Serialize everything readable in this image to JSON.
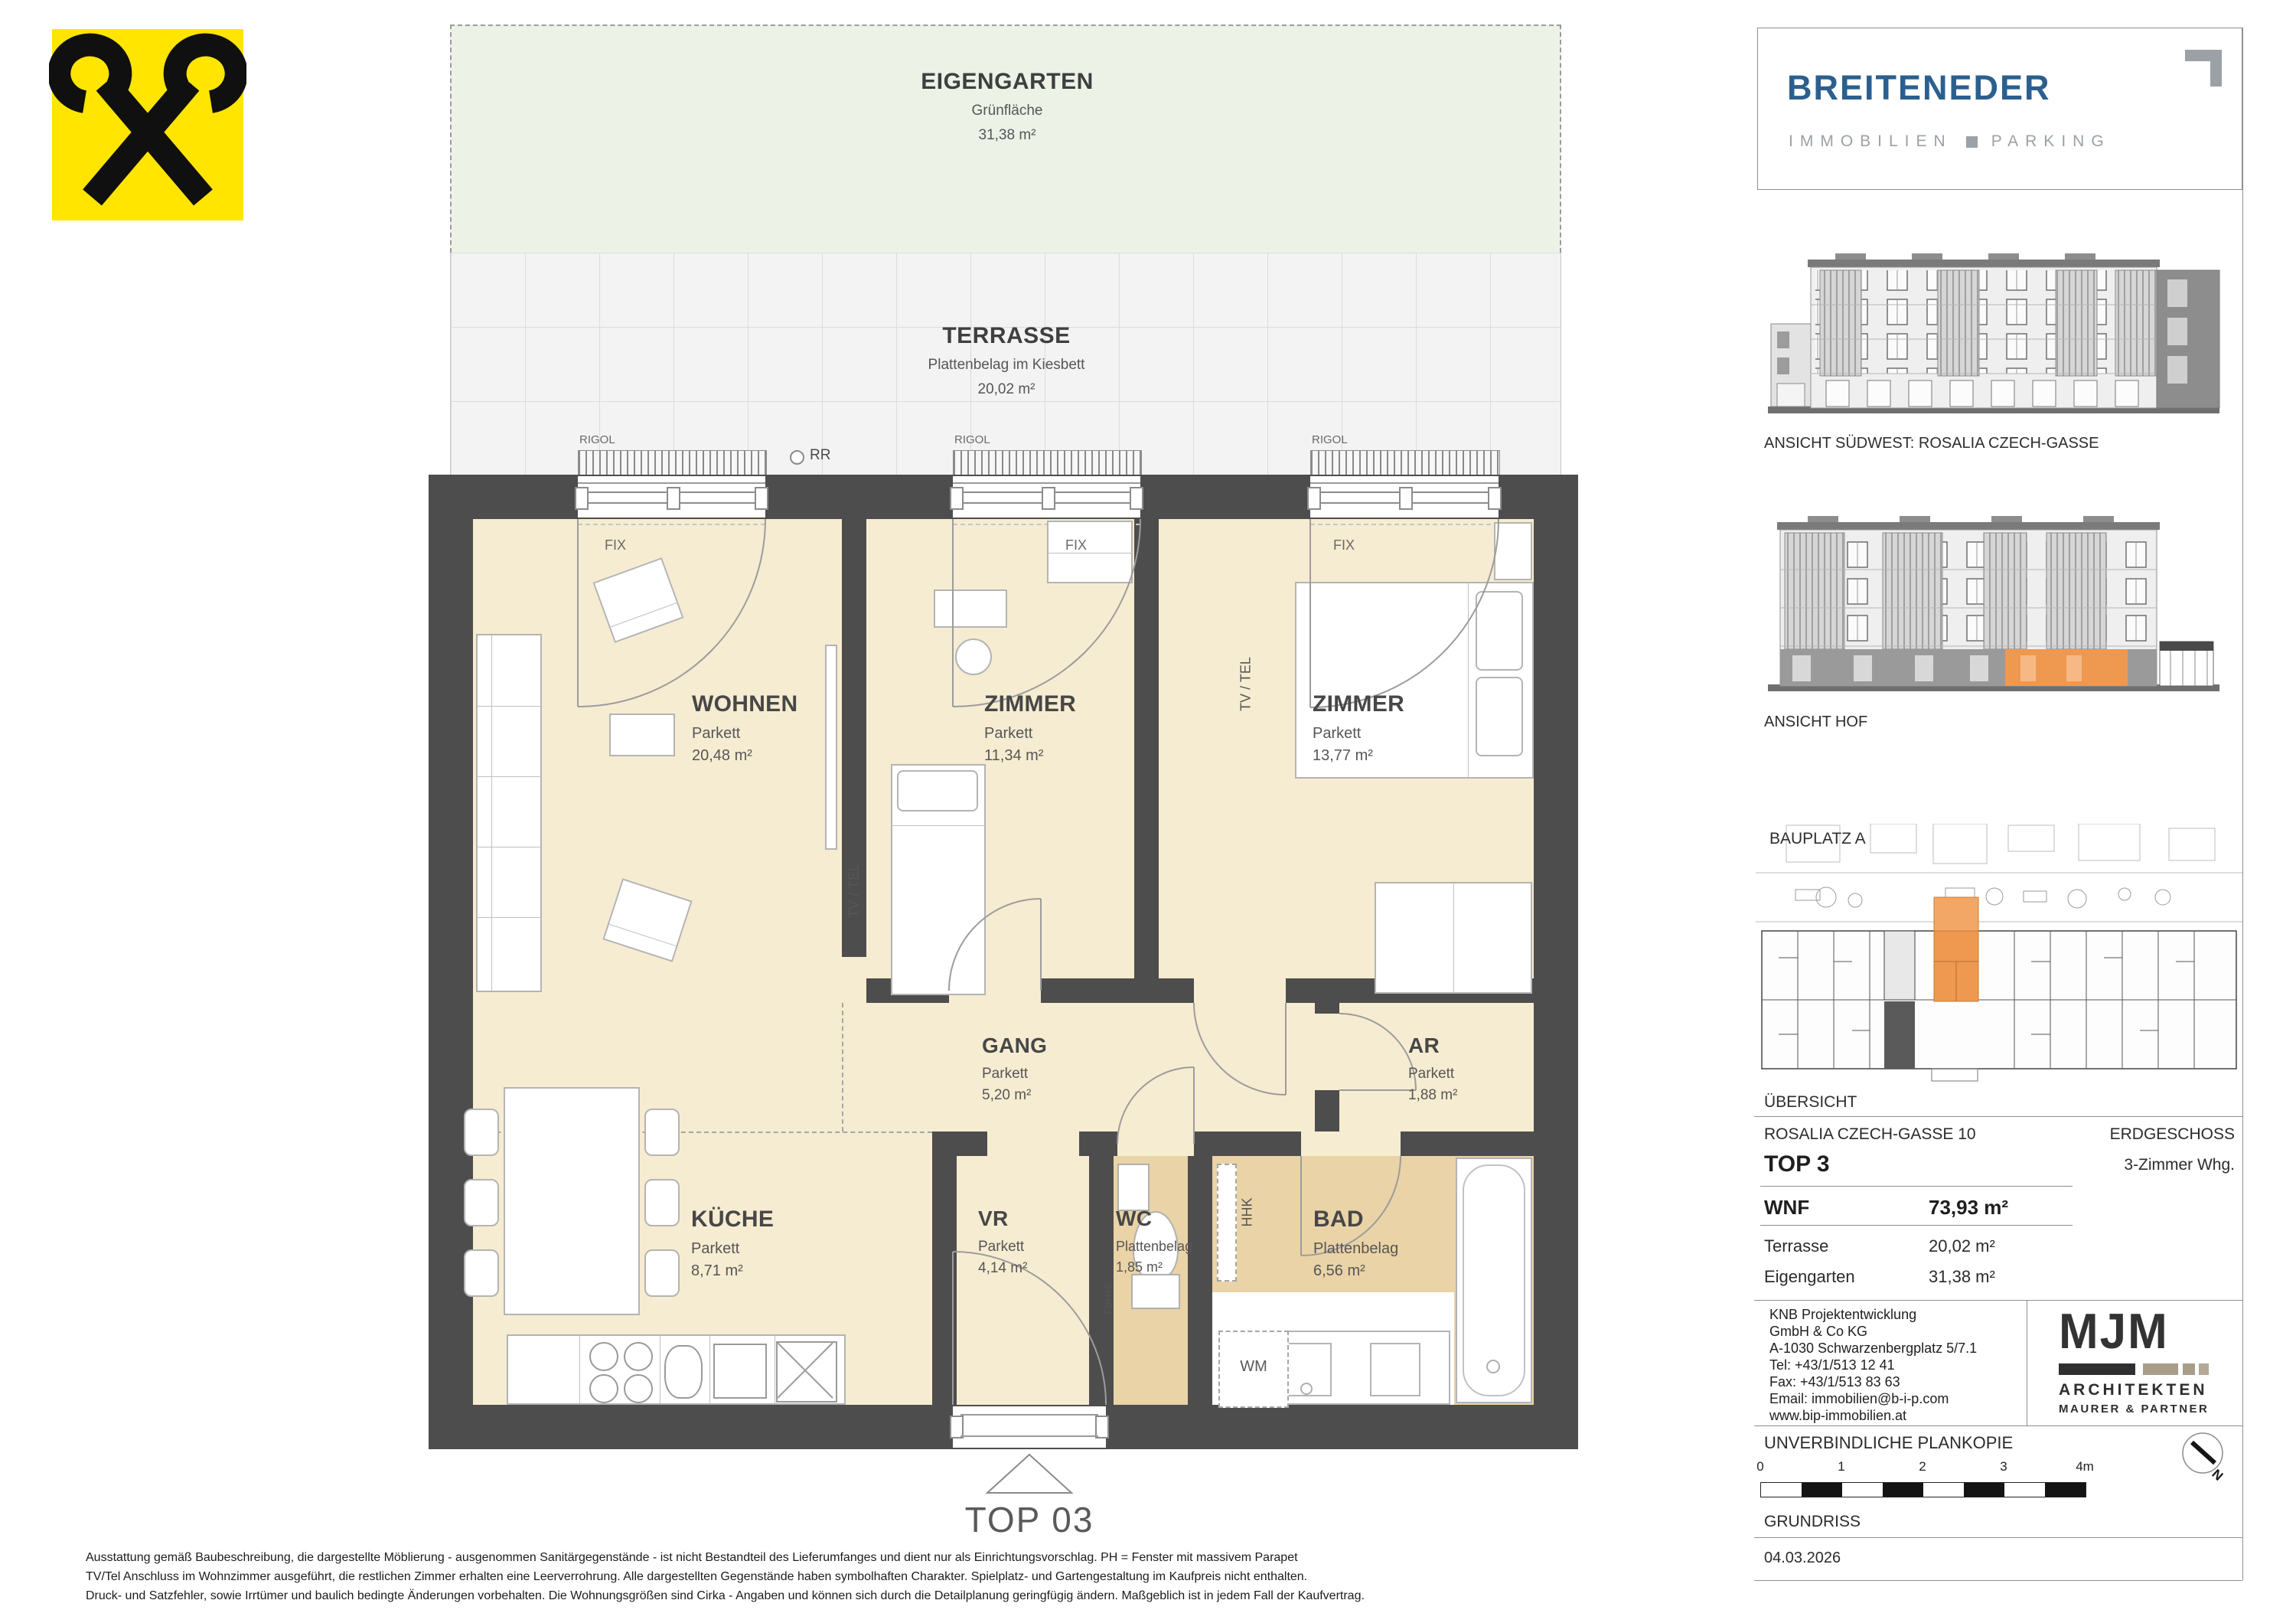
{
  "colors": {
    "accent_orange": "#EF9850",
    "brand_blue": "#2B5F8E",
    "brand_gray": "#9BA1A6",
    "raiffeisen_yellow": "#FFE500",
    "wall": "#4D4D4D",
    "room_cream": "#F6ECD1",
    "wet_room_tan": "#EAD3A6",
    "garden_green": "#EDF2E7",
    "terrace_gray": "#F3F3F3"
  },
  "plan": {
    "garden": {
      "title": "EIGENGARTEN",
      "surface": "Grünfläche",
      "area": "31,38 m²"
    },
    "terrace": {
      "title": "TERRASSE",
      "surface": "Plattenbelag im Kiesbett",
      "area": "20,02 m²"
    },
    "rooms": [
      {
        "name": "WOHNEN",
        "surface": "Parkett",
        "area": "20,48 m²"
      },
      {
        "name": "ZIMMER",
        "surface": "Parkett",
        "area": "11,34 m²"
      },
      {
        "name": "ZIMMER",
        "surface": "Parkett",
        "area": "13,77 m²"
      },
      {
        "name": "GANG",
        "surface": "Parkett",
        "area": "5,20 m²"
      },
      {
        "name": "AR",
        "surface": "Parkett",
        "area": "1,88 m²"
      },
      {
        "name": "KÜCHE",
        "surface": "Parkett",
        "area": "8,71 m²"
      },
      {
        "name": "VR",
        "surface": "Parkett",
        "area": "4,14 m²"
      },
      {
        "name": "WC",
        "surface": "Plattenbelag",
        "area": "1,85 m²"
      },
      {
        "name": "BAD",
        "surface": "Plattenbelag",
        "area": "6,56 m²"
      }
    ],
    "annotations": {
      "rigol": "RIGOL",
      "rr": "RR",
      "fix": "FIX",
      "tv_tel": "TV / TEL",
      "hhk": "HHK",
      "fbh_e": "FBH+E",
      "wm": "WM"
    },
    "entrance": "TOP 03"
  },
  "sidebar": {
    "brand": {
      "name": "BREITENEDER",
      "tagline_left": "IMMOBILIEN",
      "tagline_right": "PARKING"
    },
    "elevations": [
      {
        "caption": "ANSICHT SÜDWEST: ROSALIA CZECH-GASSE"
      },
      {
        "caption": "ANSICHT HOF"
      }
    ],
    "siteplan": {
      "title": "BAUPLATZ  A",
      "caption": "ÜBERSICHT"
    },
    "info": {
      "address": "ROSALIA CZECH-GASSE 10",
      "level": "ERDGESCHOSS",
      "unit": "TOP 3",
      "unit_type": "3-Zimmer Whg.",
      "wnf_label": "WNF",
      "wnf_value": "73,93 m²",
      "terrace_label": "Terrasse",
      "terrace_value": "20,02 m²",
      "garden_label": "Eigengarten",
      "garden_value": "31,38 m²"
    },
    "developer": {
      "line1": "KNB Projektentwicklung",
      "line2": "GmbH & Co KG",
      "line3": "A-1030 Schwarzenbergplatz 5/7.1",
      "line4": "Tel: +43/1/513 12 41",
      "line5": "Fax: +43/1/513 83 63",
      "line6": "Email: immobilien@b-i-p.com",
      "line7": "www.bip-immobilien.at"
    },
    "architect": {
      "logo": "MJM",
      "line1": "ARCHITEKTEN",
      "line2": "MAURER & PARTNER"
    },
    "plan_note": "UNVERBINDLICHE PLANKOPIE",
    "drawing_label": "GRUNDRISS",
    "date": "04.03.2026",
    "north_label": "N",
    "scale": {
      "t0": "0",
      "t1": "1",
      "t2": "2",
      "t3": "3",
      "t4": "4m"
    }
  },
  "footer": {
    "line1": "Ausstattung gemäß Baubeschreibung, die dargestellte Möblierung - ausgenommen Sanitärgegenstände - ist nicht Bestandteil des Lieferumfanges und dient nur als Einrichtungsvorschlag. PH = Fenster mit massivem Parapet",
    "line2": "TV/Tel Anschluss im Wohnzimmer ausgeführt, die restlichen Zimmer erhalten eine Leerverrohrung. Alle dargestellten Gegenstände haben symbolhaften Charakter. Spielplatz- und Gartengestaltung im Kaufpreis nicht enthalten.",
    "line3": "Druck- und Satzfehler, sowie Irrtümer und baulich bedingte Änderungen vorbehalten. Die Wohnungsgrößen sind Cirka - Angaben und können sich durch die Detailplanung geringfügig ändern. Maßgeblich ist in jedem Fall der Kaufvertrag."
  }
}
